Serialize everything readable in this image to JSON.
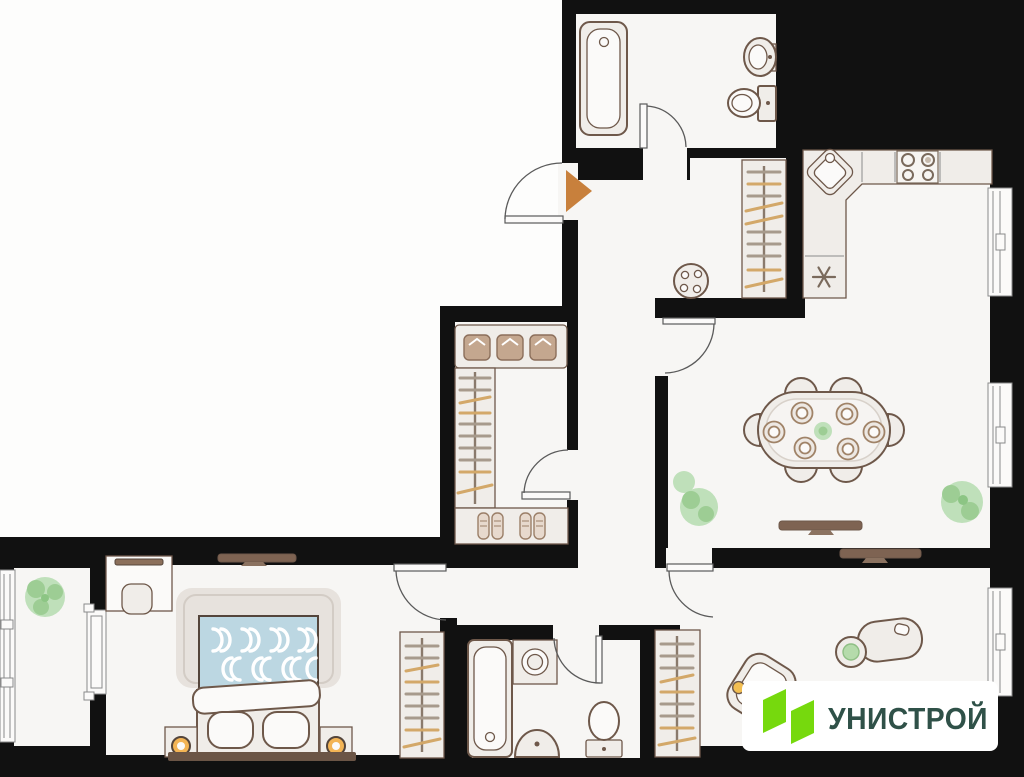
{
  "logo": {
    "text": "УНИСТРОЙ"
  },
  "colors": {
    "background": "#131313",
    "wall": "#111111",
    "exterior": "#FDFDFC",
    "floor": "#F7F6F4",
    "furn-fill": "#F0EDE9",
    "furn-white": "#FBFAF9",
    "furn-stroke": "#6E584A",
    "door-arc": "#5a5a5a",
    "window-frame": "#8a8a8a",
    "rail": "#8a7a6c",
    "hanger-tan": "#D3A869",
    "hanger-gray": "#A79A8C",
    "tv": "#7E6352",
    "wood-dark": "#6B5546",
    "blanket": "#BCD7E2",
    "plant": "#BFE0BA",
    "plant-dark": "#9DCD94",
    "lamp": "#F3B455",
    "door-marker": "#C8803C",
    "appliance-line": "#7a6a5c",
    "clothes": "#C4A78F",
    "logo-green": "#76D90D",
    "logo-text": "#2F5148"
  },
  "plan": {
    "type": "apartment-floor-plan",
    "rooms": [
      "bathroom-top",
      "entry-hall",
      "kitchen-dining-room",
      "walk-in-closet",
      "balcony",
      "bedroom",
      "bathroom-bottom",
      "bedroom-second",
      "corridor"
    ],
    "furniture": [
      "bathtub",
      "wall-sink",
      "toilet",
      "kitchen-counter",
      "corner-sink",
      "stove",
      "fridge",
      "hall-wardrobe",
      "pouf",
      "dining-table",
      "dining-chairs",
      "plates",
      "tv-console",
      "plants",
      "shelf-folded-clothes",
      "hanger-rail",
      "shoe-shelf",
      "desk",
      "desk-chair",
      "bed",
      "pillows",
      "nightstands",
      "lamps",
      "wardrobe",
      "washing-machine",
      "small-sink",
      "armchair",
      "office-desk",
      "office-chair"
    ],
    "entry_marker": "orange-triangle-right"
  }
}
